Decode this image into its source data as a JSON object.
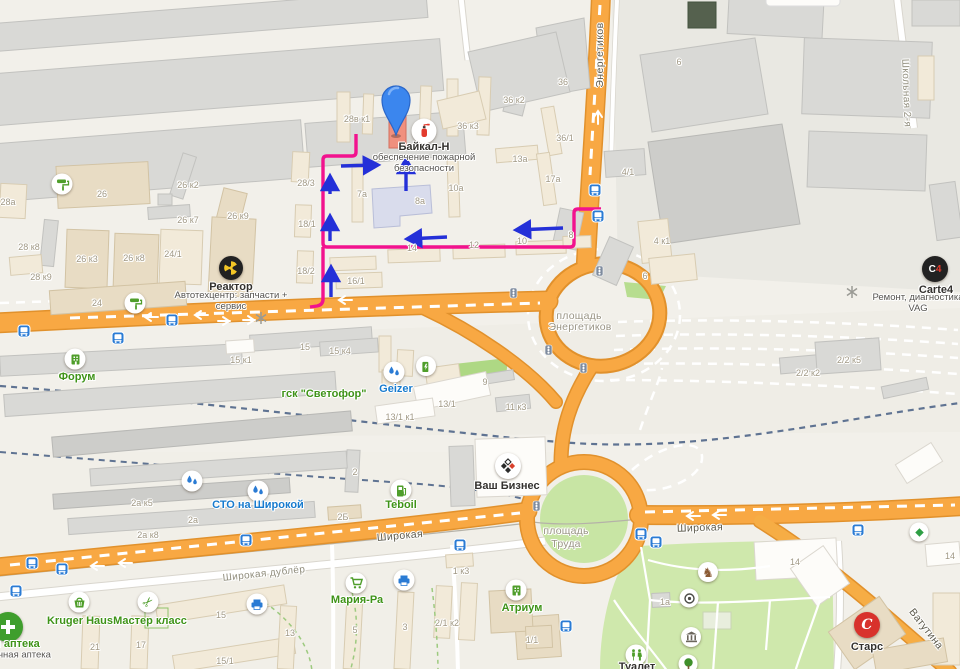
{
  "pois": [
    {
      "id": "baikal-n",
      "label": "Байкал-Н",
      "x": 424,
      "y": 147,
      "color": "dark",
      "sub": "обеспечение пожарной безопасности",
      "sx": 424,
      "sy": 164,
      "sw": 128,
      "icon": "fire-extinguisher",
      "ix": 424,
      "iy": 131,
      "istyle": "white",
      "isz": 25
    },
    {
      "id": "reaktor",
      "label": "Реактор",
      "x": 231,
      "y": 287,
      "color": "dark",
      "sub": "Автотехцентр: запчасти + сервис",
      "sx": 231,
      "sy": 302,
      "sw": 138,
      "icon": "reactor",
      "ix": 231,
      "iy": 268,
      "istyle": "black",
      "isz": 24
    },
    {
      "id": "carte4",
      "label": "Carte4",
      "x": 936,
      "y": 290,
      "color": "dark",
      "sub": "Ремонт, диагностика VAG",
      "sx": 918,
      "sy": 304,
      "sw": 112,
      "icon": "carte4",
      "ix": 935,
      "iy": 269,
      "istyle": "black",
      "isz": 26
    },
    {
      "id": "forum",
      "label": "Форум",
      "x": 77,
      "y": 377,
      "color": "green",
      "icon": "building",
      "ix": 75,
      "iy": 359,
      "istyle": "white",
      "isz": 21
    },
    {
      "id": "gsk-svetofor",
      "label": "гск \"Светофор\"",
      "x": 324,
      "y": 394,
      "color": "green"
    },
    {
      "id": "geizer",
      "label": "Geizer",
      "x": 396,
      "y": 389,
      "color": "blue",
      "icon": "water",
      "ix": 394,
      "iy": 372,
      "istyle": "white",
      "isz": 21
    },
    {
      "id": "sto-na-shirokoy",
      "label": "СТО на Широкой",
      "x": 258,
      "y": 505,
      "color": "blue",
      "icon": "water",
      "ix": 258,
      "iy": 491,
      "istyle": "white",
      "isz": 21
    },
    {
      "id": "teboil",
      "label": "Teboil",
      "x": 401,
      "y": 505,
      "color": "green",
      "icon": "fuel",
      "ix": 401,
      "iy": 490,
      "istyle": "white",
      "isz": 21
    },
    {
      "id": "vash-biznes",
      "label": "Ваш Бизнес",
      "x": 507,
      "y": 486,
      "color": "dark",
      "icon": "business",
      "ix": 508,
      "iy": 466,
      "istyle": "white",
      "isz": 26
    },
    {
      "id": "kruger-haus",
      "label": "Kruger Haus",
      "x": 80,
      "y": 621,
      "color": "green",
      "icon": "basket",
      "ix": 79,
      "iy": 602,
      "istyle": "white",
      "isz": 21
    },
    {
      "id": "master-klass",
      "label": "Мастер класс",
      "x": 150,
      "y": 621,
      "color": "green",
      "icon": "scissors",
      "ix": 148,
      "iy": 602,
      "istyle": "white",
      "isz": 21
    },
    {
      "id": "apteka",
      "label": "ая аптека",
      "x": 14,
      "y": 644,
      "color": "green",
      "sub": "очная аптека",
      "sx": 22,
      "sy": 656,
      "sw": 120,
      "icon": "pharmacy",
      "ix": 8,
      "iy": 627,
      "istyle": "green",
      "isz": 30
    },
    {
      "id": "maria-ra",
      "label": "Мария-Ра",
      "x": 357,
      "y": 600,
      "color": "green",
      "icon": "cart",
      "ix": 356,
      "iy": 583,
      "istyle": "white",
      "isz": 21
    },
    {
      "id": "atrium",
      "label": "Атриум",
      "x": 522,
      "y": 608,
      "color": "green",
      "icon": "building",
      "ix": 516,
      "iy": 590,
      "istyle": "white",
      "isz": 21
    },
    {
      "id": "stars",
      "label": "Старс",
      "x": 867,
      "y": 647,
      "color": "dark",
      "icon": "stars",
      "ix": 867,
      "iy": 625,
      "istyle": "red",
      "isz": 26
    },
    {
      "id": "tualet",
      "label": "Туалет",
      "x": 637,
      "y": 667,
      "color": "dark",
      "icon": "wc",
      "ix": 636,
      "iy": 655,
      "istyle": "white",
      "isz": 21
    }
  ],
  "street_labels": [
    {
      "t": "Энергетиков",
      "x": 600,
      "y": 55,
      "r": -90,
      "c": "road"
    },
    {
      "t": "Школьная 2-я",
      "x": 906,
      "y": 93,
      "r": 88,
      "c": "minor"
    },
    {
      "t": "Широкая",
      "x": 400,
      "y": 536,
      "r": -5,
      "c": "road"
    },
    {
      "t": "Широкая",
      "x": 700,
      "y": 528,
      "r": -2,
      "c": "road"
    },
    {
      "t": "Широкая дублёр",
      "x": 264,
      "y": 574,
      "r": -6,
      "c": "minor"
    },
    {
      "t": "Ватутина",
      "x": 926,
      "y": 629,
      "r": 52,
      "c": "road"
    },
    {
      "t": "площадь",
      "x": 579,
      "y": 316,
      "r": 0,
      "c": "area"
    },
    {
      "t": "Энергетиков",
      "x": 580,
      "y": 327,
      "r": 0,
      "c": "area"
    },
    {
      "t": "площадь",
      "x": 566,
      "y": 531,
      "r": 0,
      "c": "area"
    },
    {
      "t": "Труда",
      "x": 566,
      "y": 544,
      "r": 0,
      "c": "area"
    }
  ],
  "building_labels": [
    {
      "t": "28в к1",
      "x": 357,
      "y": 119
    },
    {
      "t": "36",
      "x": 563,
      "y": 82
    },
    {
      "t": "36 к2",
      "x": 514,
      "y": 100
    },
    {
      "t": "36 к3",
      "x": 468,
      "y": 126
    },
    {
      "t": "36/1",
      "x": 565,
      "y": 138
    },
    {
      "t": "13а",
      "x": 520,
      "y": 159
    },
    {
      "t": "17а",
      "x": 553,
      "y": 179
    },
    {
      "t": "10а",
      "x": 456,
      "y": 188
    },
    {
      "t": "8а",
      "x": 420,
      "y": 201
    },
    {
      "t": "7а",
      "x": 362,
      "y": 194
    },
    {
      "t": "28/3",
      "x": 306,
      "y": 183
    },
    {
      "t": "18/1",
      "x": 307,
      "y": 224
    },
    {
      "t": "18/2",
      "x": 306,
      "y": 271
    },
    {
      "t": "16/1",
      "x": 356,
      "y": 281
    },
    {
      "t": "14",
      "x": 412,
      "y": 248
    },
    {
      "t": "12",
      "x": 474,
      "y": 245
    },
    {
      "t": "10",
      "x": 522,
      "y": 241
    },
    {
      "t": "8",
      "x": 571,
      "y": 235
    },
    {
      "t": "4/1",
      "x": 628,
      "y": 172
    },
    {
      "t": "4 к1",
      "x": 662,
      "y": 241
    },
    {
      "t": "6",
      "x": 645,
      "y": 276
    },
    {
      "t": "28а",
      "x": 8,
      "y": 202
    },
    {
      "t": "26",
      "x": 102,
      "y": 194
    },
    {
      "t": "26 к2",
      "x": 188,
      "y": 185
    },
    {
      "t": "26 к7",
      "x": 188,
      "y": 220
    },
    {
      "t": "26 к9",
      "x": 238,
      "y": 216
    },
    {
      "t": "28 к8",
      "x": 29,
      "y": 247
    },
    {
      "t": "26 к3",
      "x": 87,
      "y": 259
    },
    {
      "t": "26 к8",
      "x": 134,
      "y": 258
    },
    {
      "t": "24/1",
      "x": 173,
      "y": 254
    },
    {
      "t": "28 к9",
      "x": 41,
      "y": 277
    },
    {
      "t": "24",
      "x": 97,
      "y": 303
    },
    {
      "t": "15 к1",
      "x": 241,
      "y": 360
    },
    {
      "t": "15",
      "x": 305,
      "y": 347
    },
    {
      "t": "15 к4",
      "x": 340,
      "y": 351
    },
    {
      "t": "13/1",
      "x": 447,
      "y": 404
    },
    {
      "t": "13/1 к1",
      "x": 400,
      "y": 417
    },
    {
      "t": "11 к3",
      "x": 516,
      "y": 407
    },
    {
      "t": "9",
      "x": 485,
      "y": 382
    },
    {
      "t": "2/2 к2",
      "x": 808,
      "y": 373
    },
    {
      "t": "2/2 к5",
      "x": 849,
      "y": 360
    },
    {
      "t": "2а к5",
      "x": 142,
      "y": 503
    },
    {
      "t": "2а",
      "x": 193,
      "y": 520
    },
    {
      "t": "2а к8",
      "x": 148,
      "y": 535
    },
    {
      "t": "2Б",
      "x": 343,
      "y": 517
    },
    {
      "t": "2",
      "x": 355,
      "y": 472
    },
    {
      "t": "1 к3",
      "x": 461,
      "y": 571
    },
    {
      "t": "21",
      "x": 95,
      "y": 647
    },
    {
      "t": "17",
      "x": 141,
      "y": 645
    },
    {
      "t": "15",
      "x": 221,
      "y": 615
    },
    {
      "t": "15/1",
      "x": 225,
      "y": 661
    },
    {
      "t": "13",
      "x": 290,
      "y": 633
    },
    {
      "t": "5",
      "x": 355,
      "y": 630
    },
    {
      "t": "3",
      "x": 405,
      "y": 627
    },
    {
      "t": "2/1 к2",
      "x": 447,
      "y": 623
    },
    {
      "t": "1/1",
      "x": 532,
      "y": 640
    },
    {
      "t": "1а",
      "x": 665,
      "y": 602
    },
    {
      "t": "14",
      "x": 795,
      "y": 562
    },
    {
      "t": "14",
      "x": 950,
      "y": 556
    },
    {
      "t": "6",
      "x": 679,
      "y": 62
    }
  ],
  "map_icons": [
    {
      "t": "paint-roller",
      "x": 62,
      "y": 184,
      "s": 21,
      "st": "white"
    },
    {
      "t": "paint-roller",
      "x": 135,
      "y": 303,
      "s": 21,
      "st": "white"
    },
    {
      "t": "ev-charge",
      "x": 426,
      "y": 366,
      "s": 20,
      "st": "white"
    },
    {
      "t": "water",
      "x": 192,
      "y": 481,
      "s": 21,
      "st": "white"
    },
    {
      "t": "printer",
      "x": 404,
      "y": 580,
      "s": 21,
      "st": "white"
    },
    {
      "t": "printer",
      "x": 257,
      "y": 604,
      "s": 21,
      "st": "white"
    },
    {
      "t": "horse",
      "x": 708,
      "y": 572,
      "s": 20,
      "st": "white"
    },
    {
      "t": "camera",
      "x": 689,
      "y": 598,
      "s": 19,
      "st": "white"
    },
    {
      "t": "museum",
      "x": 691,
      "y": 637,
      "s": 20,
      "st": "white"
    },
    {
      "t": "tree",
      "x": 688,
      "y": 664,
      "s": 19,
      "st": "white"
    },
    {
      "t": "diamond",
      "x": 919,
      "y": 532,
      "s": 19,
      "st": "white"
    },
    {
      "t": "bus-stop",
      "x": 595,
      "y": 190,
      "s": 13,
      "st": "raw"
    },
    {
      "t": "bus-stop",
      "x": 598,
      "y": 216,
      "s": 13,
      "st": "raw"
    },
    {
      "t": "bus-stop",
      "x": 24,
      "y": 331,
      "s": 13,
      "st": "raw"
    },
    {
      "t": "bus-stop",
      "x": 118,
      "y": 338,
      "s": 13,
      "st": "raw"
    },
    {
      "t": "bus-stop",
      "x": 172,
      "y": 320,
      "s": 13,
      "st": "raw"
    },
    {
      "t": "bus-stop",
      "x": 246,
      "y": 540,
      "s": 13,
      "st": "raw"
    },
    {
      "t": "bus-stop",
      "x": 641,
      "y": 534,
      "s": 13,
      "st": "raw"
    },
    {
      "t": "bus-stop",
      "x": 656,
      "y": 542,
      "s": 13,
      "st": "raw"
    },
    {
      "t": "bus-stop",
      "x": 460,
      "y": 545,
      "s": 13,
      "st": "raw"
    },
    {
      "t": "bus-stop",
      "x": 858,
      "y": 530,
      "s": 13,
      "st": "raw"
    },
    {
      "t": "bus-stop",
      "x": 566,
      "y": 626,
      "s": 13,
      "st": "raw"
    },
    {
      "t": "bus-stop",
      "x": 32,
      "y": 563,
      "s": 13,
      "st": "raw"
    },
    {
      "t": "bus-stop",
      "x": 62,
      "y": 569,
      "s": 13,
      "st": "raw"
    },
    {
      "t": "bus-stop",
      "x": 16,
      "y": 591,
      "s": 13,
      "st": "raw"
    },
    {
      "t": "traffic-light",
      "x": 513,
      "y": 293,
      "s": 11,
      "st": "raw"
    },
    {
      "t": "traffic-light",
      "x": 548,
      "y": 350,
      "s": 11,
      "st": "raw"
    },
    {
      "t": "traffic-light",
      "x": 583,
      "y": 368,
      "s": 11,
      "st": "raw"
    },
    {
      "t": "traffic-light",
      "x": 536,
      "y": 506,
      "s": 11,
      "st": "raw"
    },
    {
      "t": "traffic-light",
      "x": 599,
      "y": 271,
      "s": 11,
      "st": "raw"
    },
    {
      "t": "rail-cross",
      "x": 261,
      "y": 318,
      "s": 12,
      "st": "raw"
    },
    {
      "t": "rail-cross",
      "x": 852,
      "y": 292,
      "s": 12,
      "st": "raw"
    }
  ],
  "route": {
    "color": "#f2128e",
    "arrow_color": "#2430d8"
  },
  "colors": {
    "road_orange": "#f8a843",
    "road_casing": "#e1912c",
    "park": "#cfe8ac",
    "rail": "#5f7392",
    "pin_blue": "#3b86ee",
    "route_magenta": "#f2128e"
  }
}
